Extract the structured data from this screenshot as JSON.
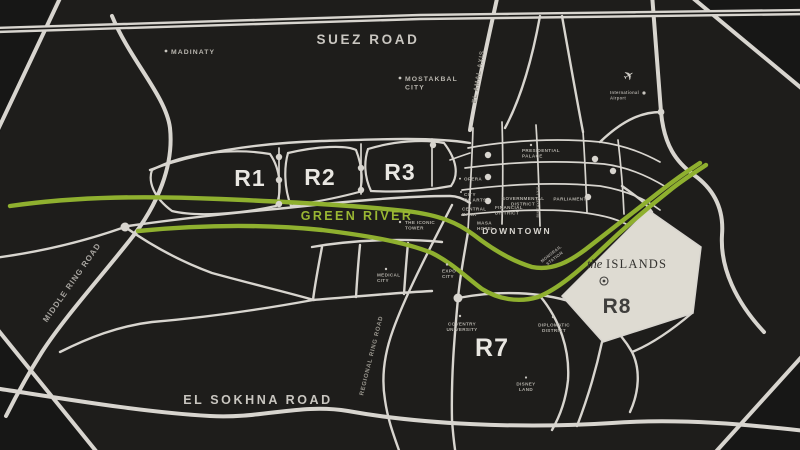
{
  "colors": {
    "background": "#1e1d1b",
    "corner_shade": "#171716",
    "road": "#d8d5cf",
    "green_river": "#8fb02f",
    "island_fill": "#dedbd2",
    "label_light": "#b2afa8",
    "district_text": "#e9e7e2",
    "dark_text": "#3f3e3c"
  },
  "roads": {
    "suez_road": "SUEZ ROAD",
    "el_sokhna_road": "EL SOKHNA ROAD",
    "middle_ring_road": "MIDDLE RING ROAD",
    "regional_ring_road": "REGIONAL RING ROAD",
    "el_amal_axis": "EL AMAL AXIS",
    "bin_zayed_axis": "BIN ZAYED AXIS"
  },
  "districts": {
    "r1": "R1",
    "r2": "R2",
    "r3": "R3",
    "r7": "R7",
    "r8": "R8",
    "downtown": "DOWNTOWN",
    "islands_the": "the",
    "islands_name": "ISLANDS"
  },
  "green_river_label": "GREEN RIVER",
  "pois": {
    "madinaty": "MADINATY",
    "mostakbal_city": [
      "MOSTAKBAL",
      "CITY"
    ],
    "international_airport": [
      "International",
      "Airport"
    ],
    "iconic_tower": [
      "THE ICONIC",
      "TOWER"
    ],
    "presidential_palace": [
      "PRESIDENTIAL",
      "PALACE"
    ],
    "opera": "OPERA",
    "city_of_arts": [
      "CITY",
      "OF ARTS"
    ],
    "central_bank": [
      "CENTRAL",
      "BANK"
    ],
    "financial_district": [
      "FINANCIAL",
      "DISTRICT"
    ],
    "governmental_district": [
      "GOVERNMENTAL",
      "DISTRICT"
    ],
    "parliament": "PARLIAMENT",
    "masa_hotel": [
      "MASA",
      "HOTEL"
    ],
    "medical_city": [
      "MEDICAL",
      "CITY"
    ],
    "expo_city": [
      "EXPO",
      "CITY"
    ],
    "monorail_station": [
      "MONORAIL",
      "STATION"
    ],
    "coventry_university": [
      "COVENTRY",
      "UNIVERSITY"
    ],
    "diplomatic_district": [
      "DIPLOMATIC",
      "DISTRICT"
    ],
    "disney_land": [
      "DISNEY",
      "LAND"
    ]
  },
  "icons": {
    "airplane": "✈"
  }
}
